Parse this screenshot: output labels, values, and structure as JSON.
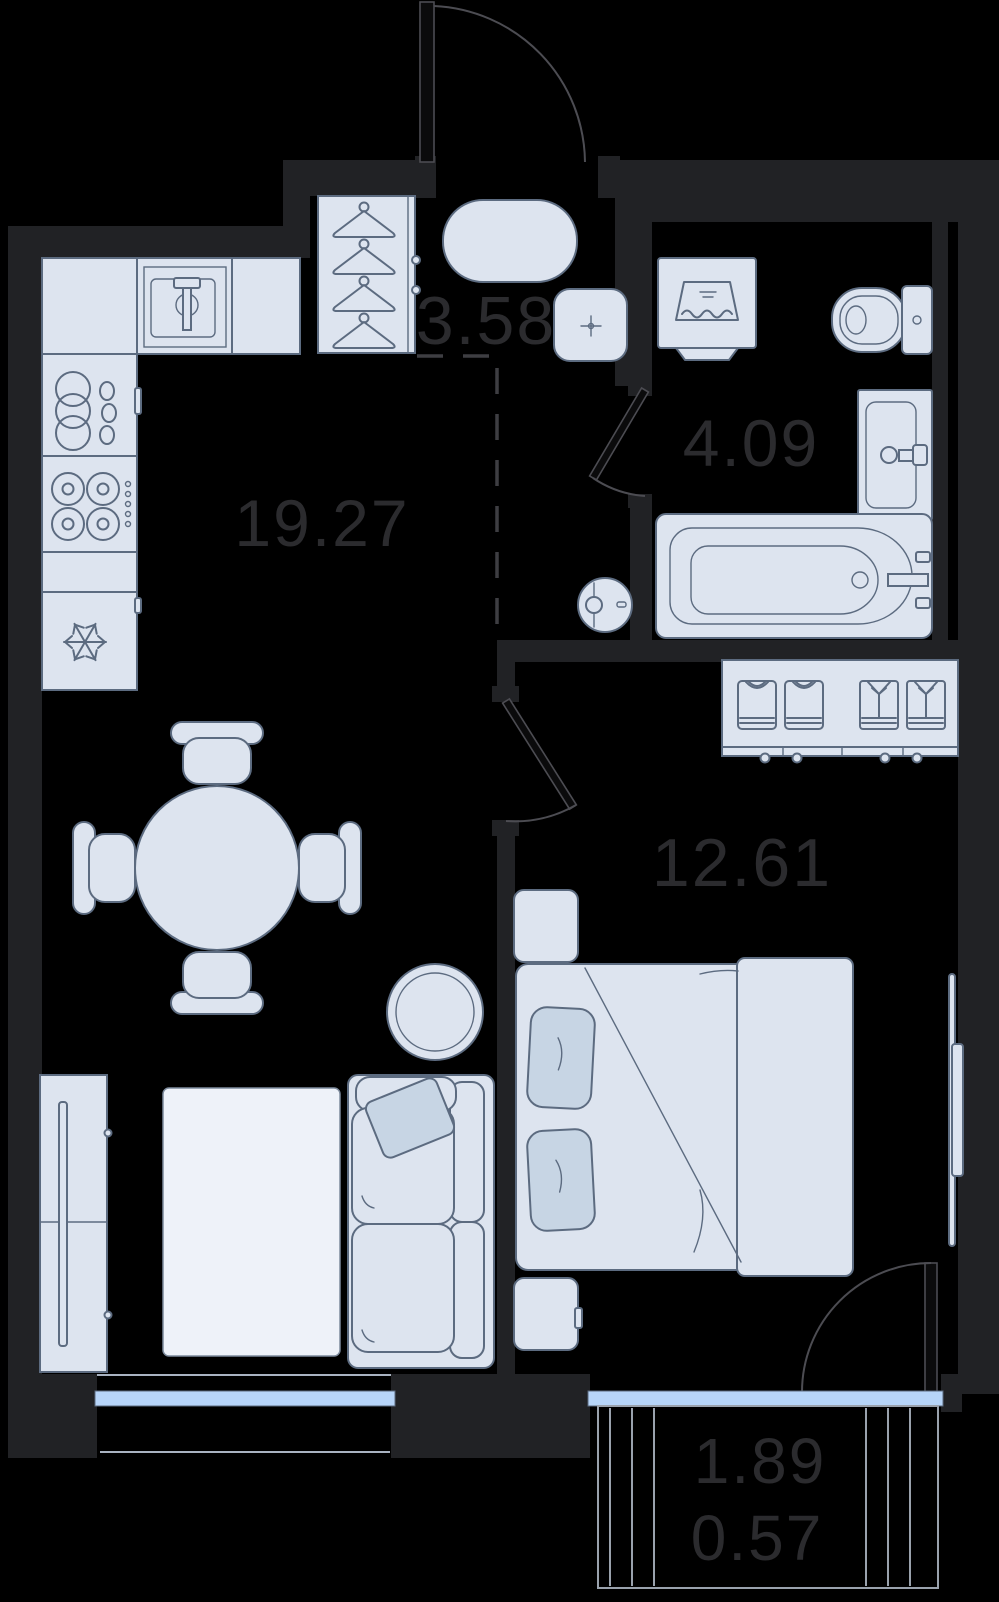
{
  "plan": {
    "type": "apartment-floor-plan",
    "rooms": [
      {
        "id": "kitchen-living-room",
        "area": "19.27"
      },
      {
        "id": "hallway",
        "area": "3.58"
      },
      {
        "id": "bathroom",
        "area": "4.09"
      },
      {
        "id": "bedroom",
        "area": "12.61"
      }
    ],
    "balcony": {
      "area": "1.89",
      "reduced_area": "0.57"
    },
    "colors": {
      "background": "#000000",
      "wall": "#212225",
      "furniture_fill": "#dde4ef",
      "furniture_stroke": "#5c6b80",
      "accent_fill": "#c7d5e4",
      "rug_fill": "#eef2f9",
      "label": "#2b2b2e",
      "glazing": "#b7d5f9",
      "door_line": "#4c4c52",
      "balcony_line": "#9aa2ad",
      "sill_line": "#a9b3c1",
      "dash_line": "#3e3e42"
    },
    "icons": [
      "hanger-icon",
      "tshirt-icon",
      "shirt-icon",
      "snowflake-icon",
      "burner-icon",
      "dish-rack-icon",
      "laundry-icon",
      "faucet-icon",
      "crosshair-icon"
    ]
  }
}
